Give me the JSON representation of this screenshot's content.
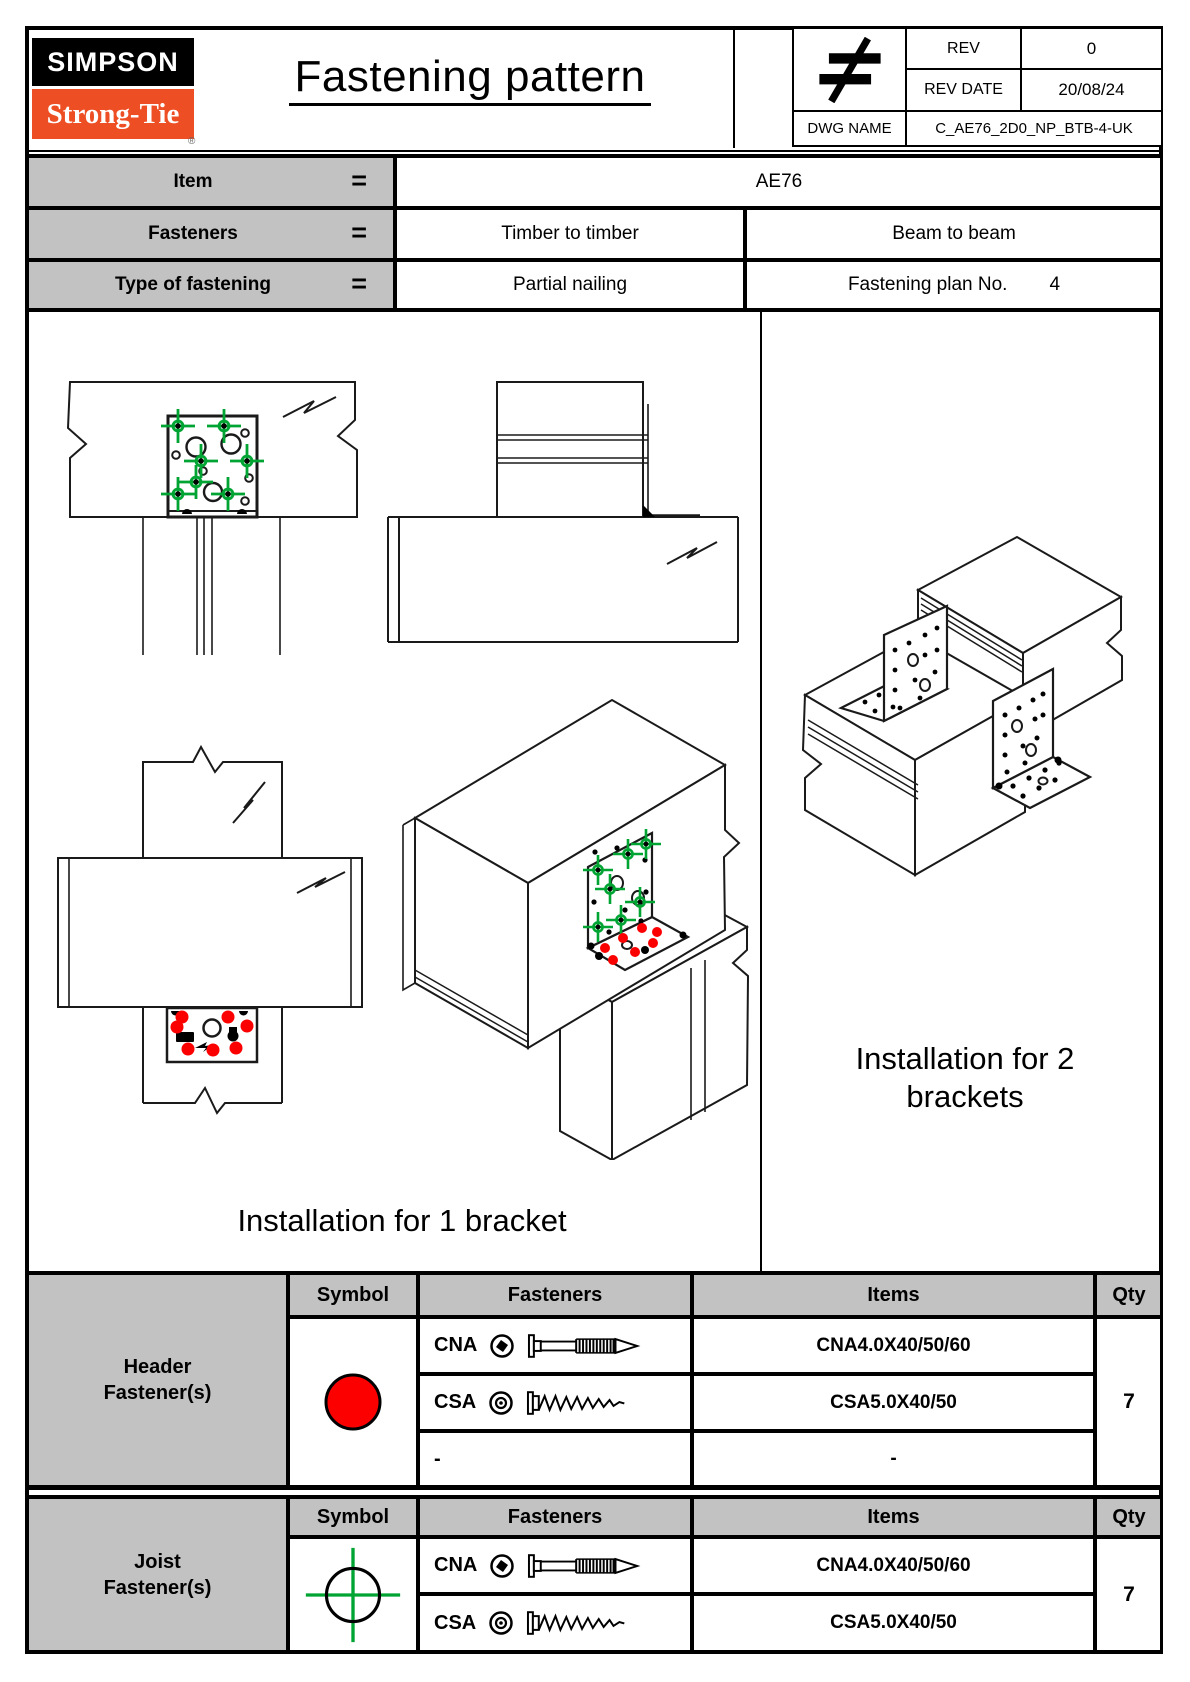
{
  "colors": {
    "brand_orange": "#EE4E23",
    "table_gray": "#C2C2C2",
    "fastener_red": "#FC0000",
    "fastener_green": "#00A433"
  },
  "title_block": {
    "brand_top": "SIMPSON",
    "brand_bottom": "Strong-Tie",
    "registered_mark": "®",
    "doc_title": "Fastening pattern",
    "rev_label": "REV",
    "rev_value": "0",
    "rev_date_label": "REV DATE",
    "rev_date_value": "20/08/24",
    "dwg_label": "DWG NAME",
    "dwg_value": "C_AE76_2D0_NP_BTB-4-UK"
  },
  "info_table": {
    "rows": [
      {
        "label": "Item",
        "eq": "=",
        "value": "AE76"
      },
      {
        "label": "Fasteners",
        "eq": "=",
        "value_left": "Timber to timber",
        "value_right": "Beam to beam"
      },
      {
        "label": "Type of fastening",
        "eq": "=",
        "value_left": "Partial nailing",
        "plan_label": "Fastening plan No.",
        "plan_value": "4"
      }
    ]
  },
  "drawing_area": {
    "caption_one_bracket": "Installation for 1 bracket",
    "caption_two_line1": "Installation for 2",
    "caption_two_line2": "brackets"
  },
  "fastener_tables": [
    {
      "group_line1": "Header",
      "group_line2": "Fastener(s)",
      "symbol": "red-dot",
      "col_symbol": "Symbol",
      "col_fasteners": "Fasteners",
      "col_items": "Items",
      "col_qty": "Qty",
      "rows": [
        {
          "code": "CNA",
          "item": "CNA4.0X40/50/60"
        },
        {
          "code": "CSA",
          "item": "CSA5.0X40/50"
        },
        {
          "code": "-",
          "item": "-"
        }
      ],
      "qty": "7"
    },
    {
      "group_line1": "Joist",
      "group_line2": "Fastener(s)",
      "symbol": "green-crosshair",
      "col_symbol": "Symbol",
      "col_fasteners": "Fasteners",
      "col_items": "Items",
      "col_qty": "Qty",
      "rows": [
        {
          "code": "CNA",
          "item": "CNA4.0X40/50/60"
        },
        {
          "code": "CSA",
          "item": "CSA5.0X40/50"
        }
      ],
      "qty": "7"
    }
  ]
}
